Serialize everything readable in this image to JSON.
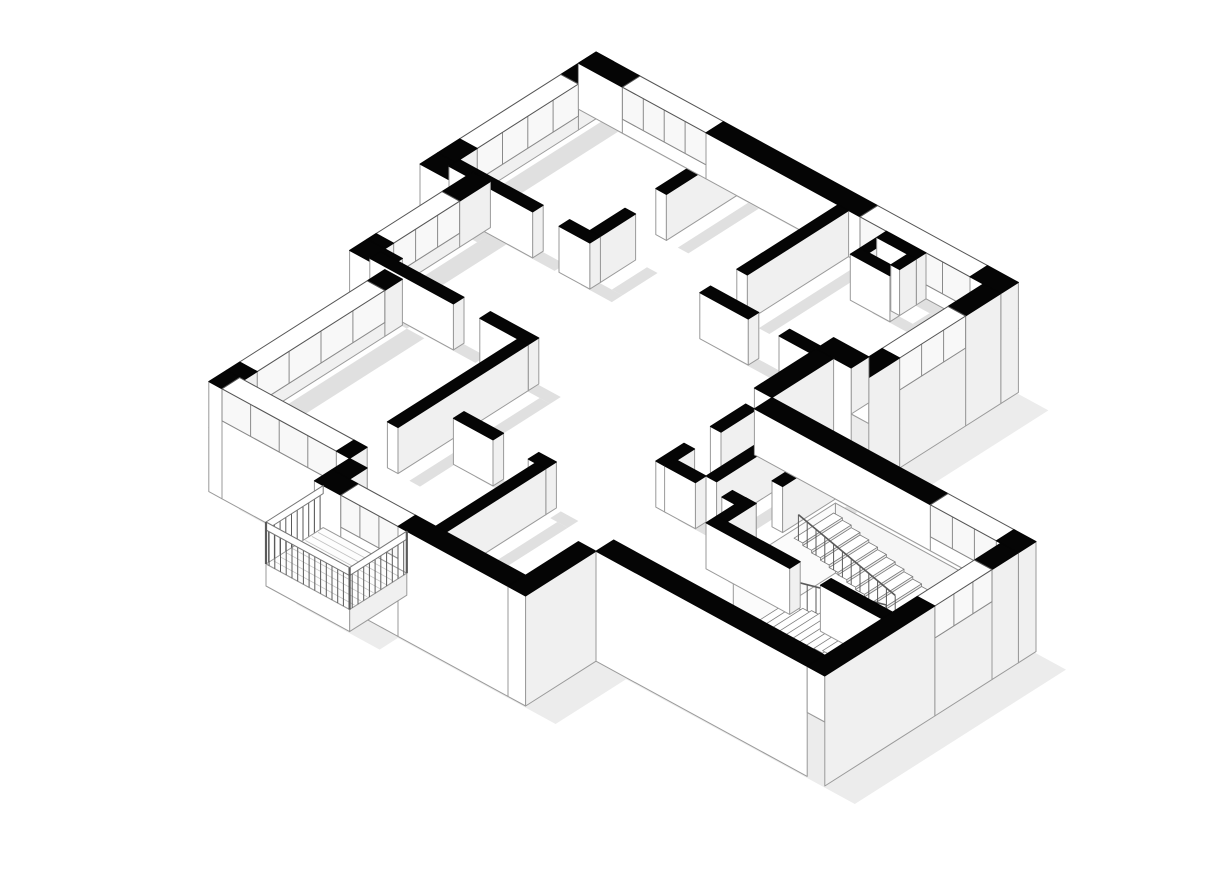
{
  "page": {
    "background": "#ffffff"
  },
  "floorplan": {
    "canvas": {
      "width": 1206,
      "height": 887
    },
    "projection": {
      "origin": [
        596,
        98
      ],
      "ux": 44,
      "uy": 24,
      "vx": -44,
      "vy": 28,
      "wall_height": 46,
      "base_depth": 64
    },
    "colors": {
      "background": "#ffffff",
      "wall_cut": "#050505",
      "face_light": "#ffffff",
      "face_shade": "#f0f0f0",
      "floor": "#ffffff",
      "shadow": "#e0e0e0",
      "ground_shadow": "#ececec",
      "edge": "#9a9a9a",
      "edge_dark": "#555555",
      "glass": "#f8f8f8",
      "mullion": "#8a8a8a",
      "tread": "#ffffff",
      "tread_edge": "#7d7d7d",
      "riser": "#f1f1f1",
      "rail": "#5a5a5a",
      "pit_far": "#f6f6f6",
      "pit_side": "#fbfbfb",
      "plank": "#c2c2c2",
      "slab_edge": "#aaaaaa"
    },
    "shadow_offset": [
      22,
      13
    ],
    "ground_shadow_offset": [
      30,
      18
    ],
    "sill_height": 14,
    "perimeter": [
      [
        0,
        0
      ],
      [
        9.6,
        0
      ],
      [
        9.6,
        3.4
      ],
      [
        8.4,
        3.4
      ],
      [
        8.4,
        4.8
      ],
      [
        14.8,
        4.8
      ],
      [
        14.8,
        9.6
      ],
      [
        9.6,
        9.6
      ],
      [
        9.6,
        11.2
      ],
      [
        4.8,
        11.2
      ],
      [
        4.8,
        10.4
      ],
      [
        1.6,
        10.4
      ],
      [
        1.6,
        6.4
      ],
      [
        0.8,
        6.4
      ],
      [
        0.8,
        3.6
      ],
      [
        0,
        3.6
      ]
    ],
    "walls": [
      {
        "name": "ne-facade",
        "u0": 0.0,
        "v0": 0.0,
        "u1": 9.6,
        "v1": 0.4,
        "ext": true,
        "skirt": "se",
        "win": [
          [
            1.0,
            2.9
          ],
          [
            6.4,
            8.9
          ]
        ]
      },
      {
        "name": "nw-facade-upper",
        "u0": 0.0,
        "v0": 0.0,
        "u1": 0.4,
        "v1": 3.6,
        "ext": true,
        "win": [
          [
            0.8,
            3.1
          ]
        ]
      },
      {
        "name": "nw-jog-upper",
        "u0": 0.0,
        "v0": 3.6,
        "u1": 0.8,
        "v1": 4.0,
        "ext": true
      },
      {
        "name": "nw-facade-mid",
        "u0": 0.8,
        "v0": 3.6,
        "u1": 1.2,
        "v1": 6.0,
        "ext": true,
        "win": [
          [
            0.7,
            2.2
          ]
        ]
      },
      {
        "name": "nw-jog-lower",
        "u0": 0.8,
        "v0": 6.0,
        "u1": 1.6,
        "v1": 6.4,
        "ext": true
      },
      {
        "name": "west-facade",
        "u0": 1.6,
        "v0": 6.4,
        "u1": 2.0,
        "v1": 10.0,
        "ext": true,
        "win": [
          [
            0.4,
            3.3
          ]
        ]
      },
      {
        "name": "sw-facade",
        "u0": 1.6,
        "v0": 10.0,
        "u1": 4.8,
        "v1": 10.4,
        "ext": true,
        "skirt": "sw",
        "win": [
          [
            0.3,
            2.9
          ]
        ]
      },
      {
        "name": "balcony-corner-block",
        "u0": 4.8,
        "v0": 10.4,
        "u1": 5.2,
        "v1": 10.8,
        "ext": true,
        "skirt": "sw,se"
      },
      {
        "name": "south-facade",
        "u0": 4.8,
        "v0": 10.8,
        "u1": 9.2,
        "v1": 11.2,
        "ext": true,
        "skirt": "sw",
        "win": [
          [
            0.6,
            1.9
          ]
        ]
      },
      {
        "name": "bottom-room-east",
        "u0": 9.2,
        "v0": 9.6,
        "u1": 9.6,
        "v1": 11.2,
        "ext": true,
        "skirt": "se,sw"
      },
      {
        "name": "wing-sw-facade",
        "u0": 9.6,
        "v0": 9.2,
        "u1": 14.4,
        "v1": 9.6,
        "ext": true,
        "skirt": "sw"
      },
      {
        "name": "wing-se-facade",
        "u0": 14.4,
        "v0": 5.2,
        "u1": 14.8,
        "v1": 9.6,
        "ext": true,
        "skirt": "se",
        "win": [
          [
            0.6,
            1.9
          ]
        ]
      },
      {
        "name": "wing-ne-facade",
        "u0": 8.8,
        "v0": 4.8,
        "u1": 14.8,
        "v1": 5.2,
        "ext": true,
        "skirt": "se",
        "win": [
          [
            4.0,
            5.5
          ]
        ]
      },
      {
        "name": "notch-side",
        "u0": 8.4,
        "v0": 3.4,
        "u1": 8.8,
        "v1": 4.8,
        "ext": true,
        "skirt": "se"
      },
      {
        "name": "notch-top",
        "u0": 8.4,
        "v0": 3.0,
        "u1": 9.2,
        "v1": 3.4,
        "ext": true,
        "skirt": "sw"
      },
      {
        "name": "east-room-facade",
        "u0": 9.2,
        "v0": 0.4,
        "u1": 9.6,
        "v1": 3.4,
        "ext": true,
        "skirt": "se",
        "win": [
          [
            0.8,
            2.3
          ]
        ]
      },
      {
        "name": "bedroom1-south",
        "u0": 0.4,
        "v0": 3.5,
        "u1": 2.3,
        "v1": 3.74
      },
      {
        "name": "bedroom1-south-jamb",
        "u0": 2.9,
        "v0": 3.5,
        "u1": 3.6,
        "v1": 3.74
      },
      {
        "name": "bedroom1-divider",
        "u0": 3.36,
        "v0": 0.4,
        "u1": 3.6,
        "v1": 2.0
      },
      {
        "name": "bedroom1-divider-jamb",
        "u0": 3.36,
        "v0": 2.7,
        "u1": 3.6,
        "v1": 3.5
      },
      {
        "name": "bedroom2-east",
        "u0": 5.9,
        "v0": 0.4,
        "u1": 6.14,
        "v1": 2.7
      },
      {
        "name": "hall-north",
        "u0": 5.9,
        "v0": 3.3,
        "u1": 7.0,
        "v1": 3.54
      },
      {
        "name": "hall-north-east",
        "u0": 7.7,
        "v0": 3.3,
        "u1": 8.4,
        "v1": 3.54
      },
      {
        "name": "duct-north",
        "u0": 7.0,
        "v0": 0.4,
        "u1": 7.9,
        "v1": 0.62
      },
      {
        "name": "duct-south",
        "u0": 7.0,
        "v0": 1.0,
        "u1": 7.9,
        "v1": 1.22
      },
      {
        "name": "duct-west",
        "u0": 7.0,
        "v0": 0.62,
        "u1": 7.2,
        "v1": 1.0
      },
      {
        "name": "duct-east",
        "u0": 7.7,
        "v0": 0.62,
        "u1": 7.9,
        "v1": 1.0
      },
      {
        "name": "living-north",
        "u0": 1.2,
        "v0": 6.1,
        "u1": 3.1,
        "v1": 6.34
      },
      {
        "name": "living-north-east",
        "u0": 3.7,
        "v0": 6.1,
        "u1": 4.8,
        "v1": 6.34
      },
      {
        "name": "study-east",
        "u0": 4.56,
        "v0": 6.34,
        "u1": 4.8,
        "v1": 9.3
      },
      {
        "name": "living-south",
        "u0": 5.3,
        "v0": 8.3,
        "u1": 6.2,
        "v1": 8.54
      },
      {
        "name": "living-south-east",
        "u0": 7.0,
        "v0": 8.3,
        "u1": 7.4,
        "v1": 8.54
      },
      {
        "name": "dining-west",
        "u0": 7.16,
        "v0": 8.54,
        "u1": 7.4,
        "v1": 10.8
      },
      {
        "name": "hall-east",
        "u0": 8.6,
        "v0": 5.2,
        "u1": 8.84,
        "v1": 6.0
      },
      {
        "name": "hall-east-south",
        "u0": 8.6,
        "v0": 6.6,
        "u1": 8.84,
        "v1": 7.24
      },
      {
        "name": "bath-corridor",
        "u0": 8.8,
        "v0": 7.0,
        "u1": 9.5,
        "v1": 7.24
      },
      {
        "name": "bath-corridor-east",
        "u0": 10.1,
        "v0": 7.0,
        "u1": 10.64,
        "v1": 7.24
      },
      {
        "name": "bath-divider",
        "u0": 9.5,
        "v0": 5.2,
        "u1": 9.74,
        "v1": 7.0
      },
      {
        "name": "stairwell-west",
        "u0": 10.4,
        "v0": 5.2,
        "u1": 10.64,
        "v1": 6.4
      },
      {
        "name": "stairwell-west-south",
        "u0": 10.4,
        "v0": 7.0,
        "u1": 10.64,
        "v1": 7.66
      },
      {
        "name": "stairwell-south",
        "u0": 10.4,
        "v0": 7.66,
        "u1": 12.3,
        "v1": 7.9
      },
      {
        "name": "stairwell-south-east",
        "u0": 13.0,
        "v0": 7.66,
        "u1": 14.4,
        "v1": 7.9
      }
    ],
    "stair": {
      "u0": 10.72,
      "v0": 5.28,
      "u1": 14.32,
      "v1": 7.6,
      "pit_depth": -70,
      "u_start": 10.85,
      "u_end": 13.25,
      "tread_count": 12,
      "rail_height": 26,
      "flights": [
        {
          "v0": 5.45,
          "v1": 6.35,
          "z_start": -2,
          "z_end": -30,
          "rail_v": 6.35
        },
        {
          "v0": 6.55,
          "v1": 7.5,
          "z_start": -62,
          "z_end": -34,
          "rail_v": 6.55
        }
      ],
      "landing": {
        "u0": 13.25,
        "u1": 14.25,
        "v0": 5.45,
        "v1": 7.5,
        "z": -32
      }
    },
    "balcony": {
      "u0": 5.0,
      "v0": 11.2,
      "u1": 6.9,
      "v1": 12.5,
      "slab_top": 4,
      "slab_bottom": -18,
      "rail_top": 46,
      "rail_band": 8,
      "baluster_step": 0.13,
      "plank_step": 0.145
    }
  }
}
